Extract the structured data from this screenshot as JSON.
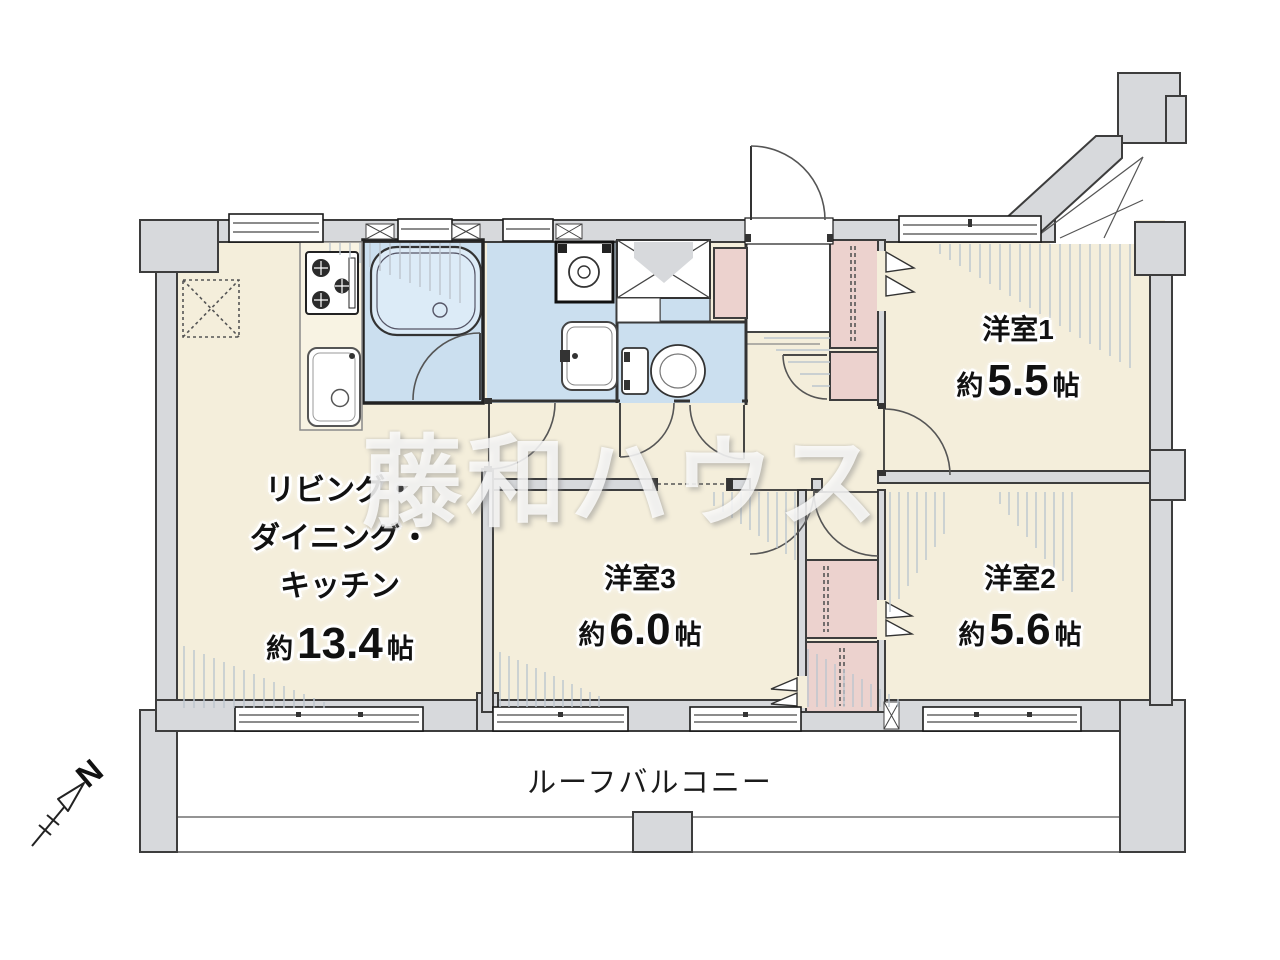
{
  "floorplan": {
    "watermark": "藤和ハウス",
    "compass": {
      "label": "N"
    },
    "balcony": {
      "label": "ルーフバルコニー"
    },
    "rooms": {
      "ldk": {
        "name_lines": [
          "リビング・",
          "ダイニング・",
          "キッチン"
        ],
        "area_prefix": "約",
        "area_value": "13.4",
        "area_unit": "帖"
      },
      "room1": {
        "name": "洋室1",
        "area_prefix": "約",
        "area_value": "5.5",
        "area_unit": "帖"
      },
      "room2": {
        "name": "洋室2",
        "area_prefix": "約",
        "area_value": "5.6",
        "area_unit": "帖"
      },
      "room3": {
        "name": "洋室3",
        "area_prefix": "約",
        "area_value": "6.0",
        "area_unit": "帖"
      }
    },
    "fixtures": [
      "stove-icon",
      "kitchen-sink-icon",
      "bathtub-icon",
      "washing-machine-icon",
      "wash-basin-icon",
      "toilet-icon",
      "pipe-space",
      "entrance-door",
      "refrigerator-space"
    ],
    "colors": {
      "floor": "#f4eedb",
      "wet_area": "#cbdfef",
      "closet": "#ecd2ce",
      "wall": "#d7d9dc"
    }
  }
}
